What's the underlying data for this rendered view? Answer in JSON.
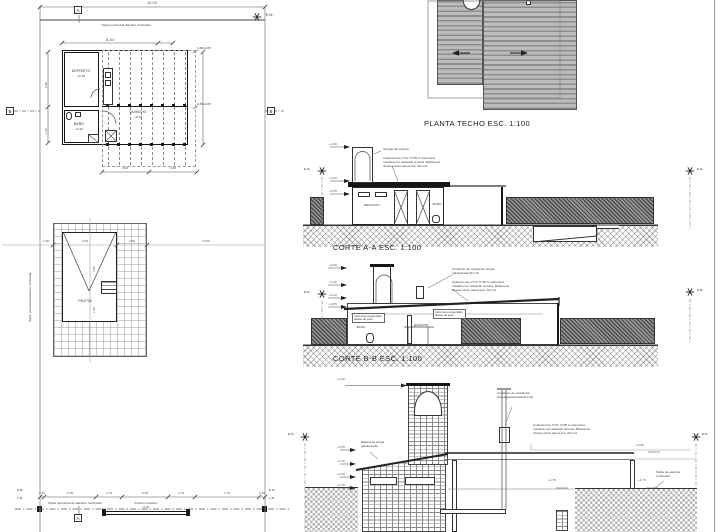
{
  "labels": {
    "em": "E.M.",
    "lm": "L.M."
  },
  "site_plan": {
    "dim_total": "16.00",
    "fence_note_top": "Tejido perimetral alambre romboidal",
    "fence_note_left": "Tejido perimetral alambre romboidal",
    "marker_a": "A",
    "marker_b": "B",
    "floor_plan": {
      "dim_top": "8.40",
      "room_deposito": "DEPOSITO",
      "level_deposito": "+0.10",
      "room_bano": "BAÑO",
      "level_bano": "+0.10",
      "room_quincho": "QUINCHO",
      "level_quincho": "+0.10",
      "dim_bottom_left": "3.08",
      "dim_bottom_right": "3.08",
      "dim_left_top": "2.95",
      "dim_left_bottom": "1.60",
      "note_right_top": "1.80×2.05",
      "note_right_bottom": "0.80×2.05"
    },
    "pool": {
      "label": "PILETA",
      "dim_length": "4.20",
      "dim_width": "2.60",
      "axis_dims": [
        "1.85",
        "4.00",
        "2.35",
        "10.00"
      ]
    },
    "gate": {
      "label": "Portón corredizo",
      "dim": "3.00",
      "fence_note": "Tejido perimetral de alambre romboidal",
      "dims": [
        "0.15",
        "5.35",
        "2.70",
        "5.48",
        "2.70",
        "7.70",
        "0.15"
      ]
    }
  },
  "roof_plan": {
    "title": "PLANTA TECHO  ESC. 1:100"
  },
  "corte_aa": {
    "title": "CORTE A-A  ESC. 1:100",
    "levels": [
      "+4.60",
      "+3.20",
      "+2.85"
    ],
    "room_left": "DEPOSITO",
    "room_right": "BAÑO",
    "note_tank": "Tanque de reserva",
    "note_roof": "Cubierta cha. H°G° N°25 s/ estructura metálica con aislación térmica. Babeta de chapa contra pared sep. 20 cms"
  },
  "corte_bb": {
    "title": "CORTE B-B  ESC. 1:100",
    "levels": [
      "+4.60",
      "+3.40",
      "+3.00",
      "+2.85"
    ],
    "room_left": "BAÑO",
    "room_right": "QUINCHO",
    "note_ceiling_left": "Cielo raso suspendido placas de yeso",
    "note_ceiling_right": "Cielo raso suspendido placas de yeso",
    "note_vent": "Conducto de ventilación chapa galvanizada Ø 0.10",
    "note_roof": "Cubierta cha. H°G° N°25 s/ estructura metálica con aislación térmica. Babeta de chapa contra pared sep. 20 cms"
  },
  "section_detail": {
    "level_top": "+4.60",
    "levels_left": [
      "+2.85",
      "+2.40",
      "+2.05",
      "+1.75"
    ],
    "level_slab": "+2.85",
    "level_ground_left": "+1.75",
    "level_ground_right": "+1.75",
    "note_vent": "Conducto de ventilación chapa galvanizada Ø 0.10",
    "note_roof": "Cubierta cha. H°G° N°25 s/ estructura metálica con aislación térmica. Babeta de chapa contra pared sep. 20 cms",
    "note_flashing": "Babeta de chapa galvanizada",
    "note_fence": "Tejido de alambre romboidal"
  }
}
